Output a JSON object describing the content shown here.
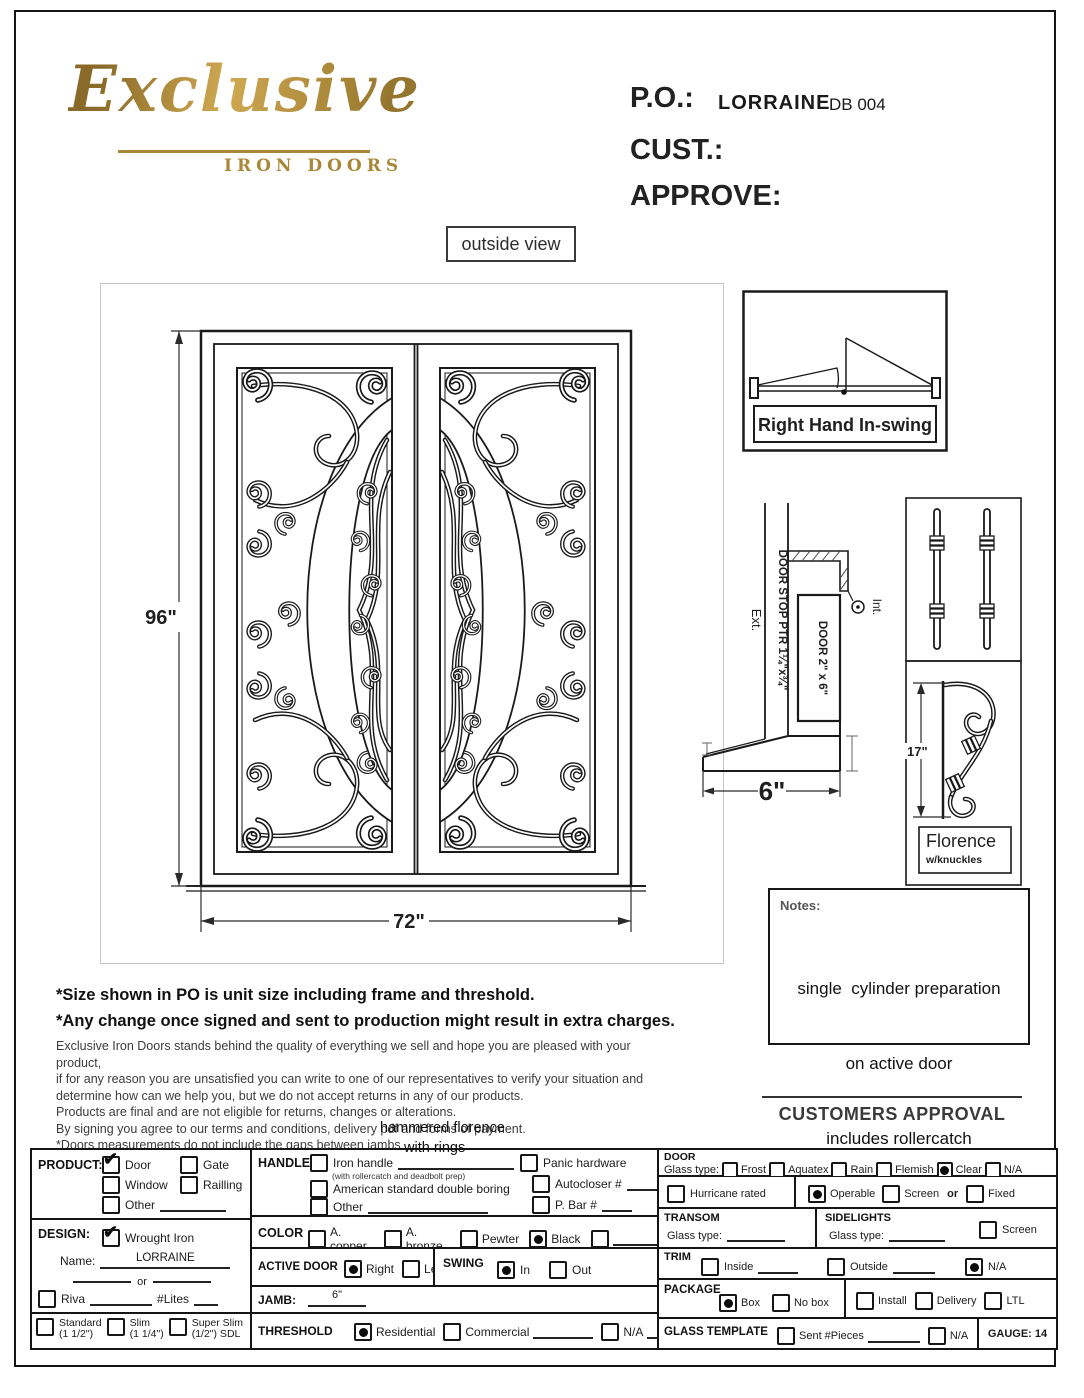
{
  "logo": {
    "brand": "Exclusive",
    "subtitle": "IRON DOORS",
    "gold": "#a98738"
  },
  "header": {
    "po_label": "P.O.:",
    "po_name": "LORRAINE",
    "po_number": "DB 004",
    "cust_label": "CUST.:",
    "approve_label": "APPROVE:"
  },
  "view_label": "outside view",
  "door_drawing": {
    "height_dim": "96\"",
    "width_dim": "72\""
  },
  "swing_box": {
    "label": "Right Hand In-swing"
  },
  "section": {
    "ext": "Ext.",
    "int": "Int.",
    "door_stop": "DOOR STOP PTR 1¼\"x¾\"",
    "door": "DOOR 2\" x 6\"",
    "width_dim": "6\""
  },
  "hardware": {
    "height_dim": "17\"",
    "name": "Florence",
    "detail": "w/knuckles"
  },
  "notes": {
    "label": "Notes:",
    "lines": [
      "single  cylinder preparation",
      "on active door",
      "includes rollercatch"
    ]
  },
  "approval_label": "CUSTOMERS APPROVAL",
  "disclaimer": {
    "bold": [
      "*Size shown in PO is unit size including frame and threshold.",
      "*Any change once signed and sent to production might result in extra charges."
    ],
    "lines": [
      "Exclusive Iron Doors stands behind the quality of everything we sell and hope you are pleased with your product,",
      "if for any reason you are unsatisfied you can write to one of our representatives to verify your situation and",
      "determine how can we help you, but we do not accept returns in any of our products.",
      "Products are final and are not eligible for returns, changes or alterations.",
      "By signing you agree to our terms and conditions, delivery pdf and forms of payment.",
      "*Doors measurements do not include the gaps between jambs"
    ]
  },
  "annotation": {
    "line1": "hammered florence",
    "line2": "with rings"
  },
  "form": {
    "product": {
      "label": "PRODUCT:",
      "door": "Door",
      "gate": "Gate",
      "window": "Window",
      "railling": "Railling",
      "other": "Other"
    },
    "design": {
      "label": "DESIGN:",
      "wrought": "Wrought Iron",
      "name_label": "Name:",
      "name_value": "LORRAINE",
      "or": "or",
      "riva": "Riva",
      "lites": "#Lites",
      "standard": "Standard",
      "standard_size": "(1 1/2\")",
      "slim": "Slim",
      "slim_size": "(1 1/4\")",
      "superslim": "Super Slim",
      "superslim_size": "(1/2\") SDL"
    },
    "handle": {
      "label": "HANDLE",
      "iron": "Iron handle",
      "iron_sub": "(with rollercatch and deadbolt prep)",
      "american": "American standard double boring",
      "other": "Other",
      "panic": "Panic hardware",
      "autocloser": "Autocloser #",
      "pbar": "P. Bar #"
    },
    "color": {
      "label": "COLOR",
      "copper": "A. copper",
      "bronze": "A. bronze",
      "pewter": "Pewter",
      "black": "Black"
    },
    "active_door": {
      "label": "ACTIVE DOOR",
      "right": "Right",
      "left": "Left"
    },
    "swing": {
      "label": "SWING",
      "in": "In",
      "out": "Out"
    },
    "jamb": {
      "label": "JAMB:",
      "value": "6\""
    },
    "threshold": {
      "label": "THRESHOLD",
      "residential": "Residential",
      "commercial": "Commercial",
      "na": "N/A"
    },
    "door": {
      "label": "DOOR",
      "glass_label": "Glass type:",
      "frost": "Frost",
      "aquatex": "Aquatex",
      "rain": "Rain",
      "flemish": "Flemish",
      "clear": "Clear",
      "na": "N/A",
      "hurricane": "Hurricane rated",
      "operable": "Operable",
      "screen": "Screen",
      "or": "or",
      "fixed": "Fixed"
    },
    "transom": {
      "label": "TRANSOM",
      "glass_label": "Glass type:"
    },
    "sidelights": {
      "label": "SIDELIGHTS",
      "glass_label": "Glass type:",
      "screen": "Screen"
    },
    "trim": {
      "label": "TRIM",
      "inside": "Inside",
      "outside": "Outside",
      "na": "N/A"
    },
    "package": {
      "label": "PACKAGE",
      "box": "Box",
      "nobox": "No box",
      "install": "Install",
      "delivery": "Delivery",
      "ltl": "LTL"
    },
    "glass_template": {
      "label": "GLASS TEMPLATE",
      "sent": "Sent  #Pieces",
      "na": "N/A",
      "gauge": "GAUGE: 14"
    },
    "checked": {
      "product": "Door",
      "design": "Wrought Iron",
      "color": "Black",
      "active_door": "Right",
      "swing": "In",
      "threshold": "Residential",
      "door_glass": "Clear",
      "door_mode": "Operable",
      "trim": "N/A",
      "package": "Box"
    }
  }
}
